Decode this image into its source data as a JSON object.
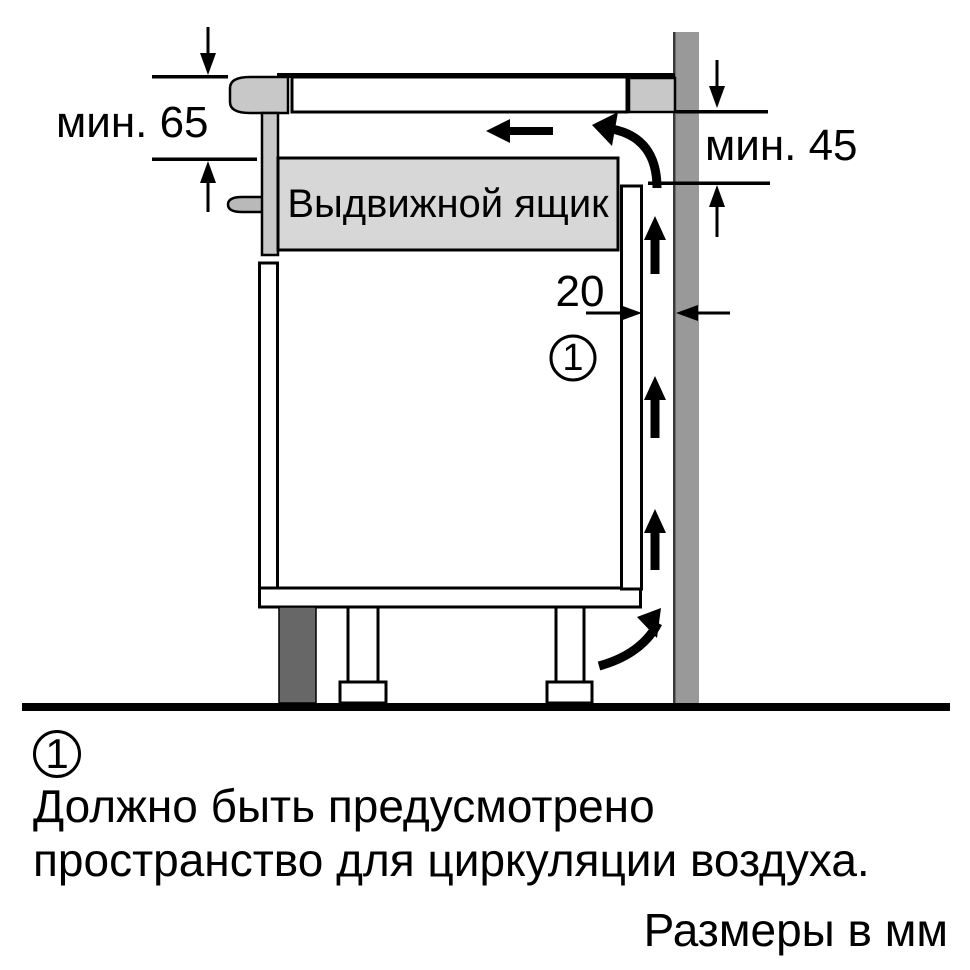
{
  "colors": {
    "background": "#ffffff",
    "line": "#000000",
    "wall": "#999999",
    "wall_edge": "#3a3a3a",
    "appliance": "#c8c8c8",
    "handle": "#b9b9b9",
    "drawer": "#d7d7d7",
    "panel": "#ffffff",
    "plinth": "#676767"
  },
  "diagram": {
    "drawer_label": "Выдвижной ящик",
    "dim_left_label": "мин. 65",
    "dim_right_label": "мин. 45",
    "dim_gap_label": "20",
    "callout_number": "1"
  },
  "legend": {
    "callout_number": "1",
    "note_line1": "Должно быть предусмотрено",
    "note_line2": "пространство для циркуляции воздуха.",
    "units_note": "Размеры в мм"
  }
}
